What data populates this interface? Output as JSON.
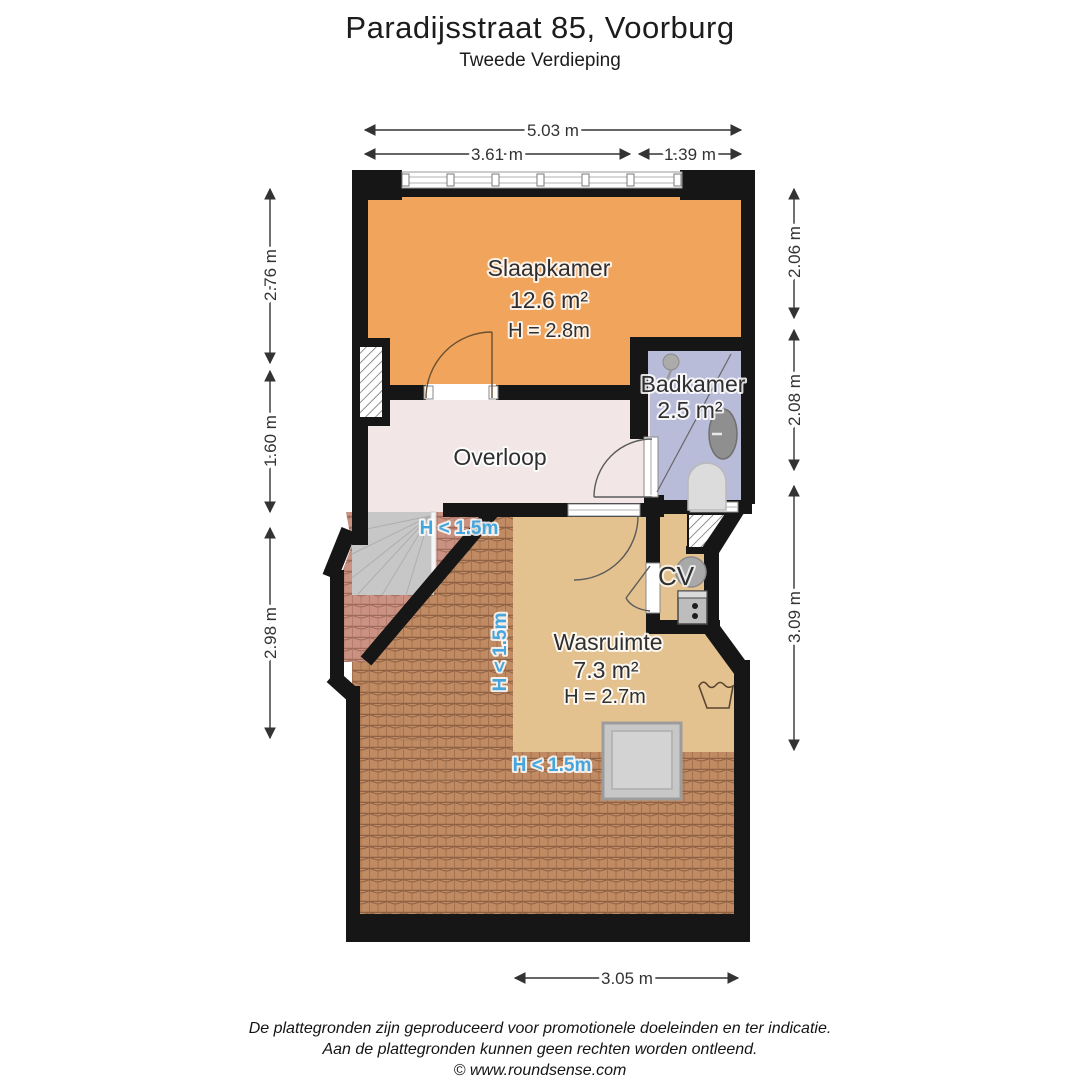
{
  "header": {
    "title": "Paradijsstraat 85, Voorburg",
    "subtitle": "Tweede Verdieping"
  },
  "rooms": {
    "slaapkamer": {
      "name": "Slaapkamer",
      "area": "12.6 m²",
      "ceiling": "H = 2.8m"
    },
    "badkamer": {
      "name": "Badkamer",
      "area": "2.5 m²"
    },
    "overloop": {
      "name": "Overloop"
    },
    "cv": {
      "name": "CV"
    },
    "wasruimte": {
      "name": "Wasruimte",
      "area": "7.3 m²",
      "ceiling": "H = 2.7m"
    }
  },
  "low_headroom": {
    "stairs": "H < 1.5m",
    "side": "H < 1.5m",
    "bottom": "H < 1.5m"
  },
  "dimensions": {
    "top_total": "5.03 m",
    "top_left_segment": "3.61 m",
    "top_right_segment": "1.39 m",
    "left_top": "2.76 m",
    "left_middle": "1.60 m",
    "left_bottom": "2.98 m",
    "right_top": "2.06 m",
    "right_middle": "2.08 m",
    "right_bottom": "3.09 m",
    "bottom": "3.05 m"
  },
  "footer": {
    "disclaimer_line1": "De plattegronden zijn geproduceerd voor promotionele doeleinden en ter indicatie.",
    "disclaimer_line2": "Aan de plattegronden kunnen geen rechten worden ontleend.",
    "credit": "© www.roundsense.com"
  },
  "colors": {
    "slaapkamer": "#F1A45B",
    "badkamer": "#B9BCD8",
    "overloop": "#F2E6E6",
    "wasruimte": "#E4C28F",
    "roof_brown": "#C08A62",
    "roof_pink": "#CB9283",
    "wall": "#161616",
    "stairs": "#C6C7C6",
    "low_headroom_text": "#45A6DE",
    "dimension_text": "#333333"
  }
}
